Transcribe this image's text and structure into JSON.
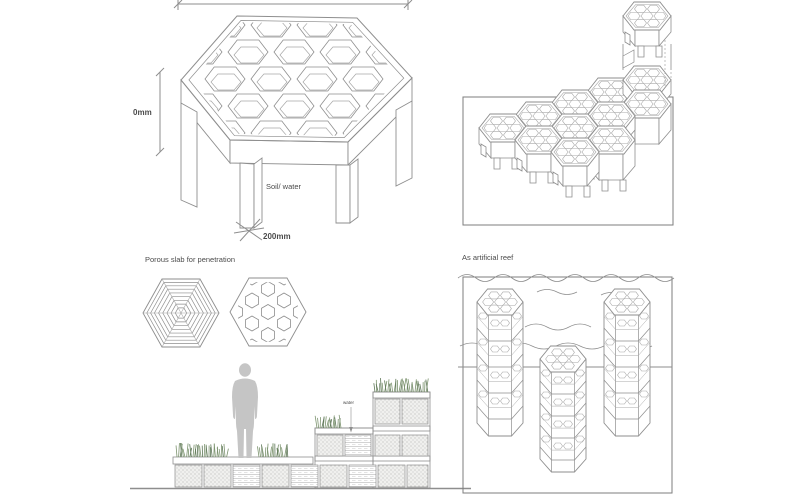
{
  "panels": {
    "hex_block": {
      "height_dim": "0mm",
      "leg_dim": "200mm",
      "env_label": "Soil/ water"
    },
    "porous": {
      "title": "Porous slab for penetration",
      "water_label": "water"
    },
    "reef": {
      "title": "As artificial reef"
    }
  },
  "colors": {
    "line": "#8e8e8e",
    "line_soft": "#a8a8a8",
    "frame": "#7d7d7d",
    "text": "#4b4b4b",
    "grass": "#7d9470",
    "grass_dark": "#5e7757",
    "person": "#c5c5c5",
    "stipple_dot": "#9a9a9a",
    "stipple_bg": "#f0f0ee",
    "water_line": "#b5b5b5",
    "paper": "#ffffff"
  }
}
